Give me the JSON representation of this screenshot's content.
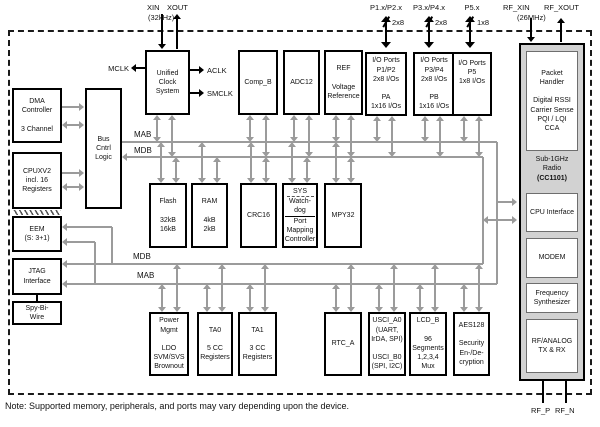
{
  "pins": {
    "xin": "XIN",
    "xout": "XOUT",
    "xtal_freq": "(32kHz)",
    "mclk": "MCLK",
    "aclk": "ACLK",
    "smclk": "SMCLK",
    "p12": "P1.x/P2.x",
    "p34": "P3.x/P4.x",
    "p5": "P5.x",
    "p12_width": "2x8",
    "p34_width": "2x8",
    "p5_width": "1x8",
    "rf_xin": "RF_XIN",
    "rf_xout": "RF_XOUT",
    "rf_freq": "(26MHz)",
    "rf_p": "RF_P",
    "rf_n": "RF_N"
  },
  "buses": {
    "mab_top": "MAB",
    "mdb_top": "MDB",
    "mdb_bottom": "MDB",
    "mab_bottom": "MAB"
  },
  "blocks": {
    "dma": "DMA\nController\n\n3 Channel",
    "bus_cntrl": "Bus\nCntrl\nLogic",
    "cpu": "CPUXV2\nincl. 16\nRegisters",
    "eem": "EEM\n(S: 3+1)",
    "jtag": "JTAG\nInterface",
    "sbw": "Spy-Bi-\nWire",
    "ucs": "Unified\nClock\nSystem",
    "comp_b": "Comp_B",
    "adc12": "ADC12",
    "ref": "REF\n\nVoltage\nReference",
    "io12": "I/O Ports\nP1/P2\n2x8 I/Os\n\nPA\n1x16 I/Os",
    "io34": "I/O Ports\nP3/P4\n2x8 I/Os\n\nPB\n1x16 I/Os",
    "io5": "I/O Ports\nP5\n1x8 I/Os",
    "flash": "Flash\n\n32kB\n16kB",
    "ram": "RAM\n\n4kB\n2kB",
    "crc16": "CRC16",
    "sys_top": "SYS",
    "sys_mid": "Watch-\ndog",
    "sys_bot": "Port\nMapping\nController",
    "mpy32": "MPY32",
    "pmm": "Power\nMgmt\n\nLDO\nSVM/SVS\nBrownout",
    "ta0": "TA0\n\n5 CC\nRegisters",
    "ta1": "TA1\n\n3 CC\nRegisters",
    "rtc": "RTC_A",
    "usci": "USCI_A0\n(UART,\nIrDA, SPI)\n\nUSCI_B0\n(SPI, I2C)",
    "lcd": "LCD_B\n\n96\nSegments\n1,2,3,4\nMux",
    "aes": "AES128\n\nSecurity\nEn-/De-\ncryption"
  },
  "radio": {
    "packet": "Packet\nHandler\n\nDigital RSSI\nCarrier Sense\nPQI / LQI\nCCA",
    "title": "Sub-1GHz\nRadio",
    "title_bold": "(CC1101)",
    "cpu_if": "CPU Interface",
    "modem": "MODEM",
    "freq": "Frequency\nSynthesizer",
    "rf": "RF/ANALOG\nTX & RX"
  },
  "note": "Note: Supported memory, peripherals, and ports may vary depending upon the device.",
  "colors": {
    "bus_gray": "#9b9b9b",
    "radio_fill": "#d2d2d2",
    "line_black": "#000000"
  }
}
